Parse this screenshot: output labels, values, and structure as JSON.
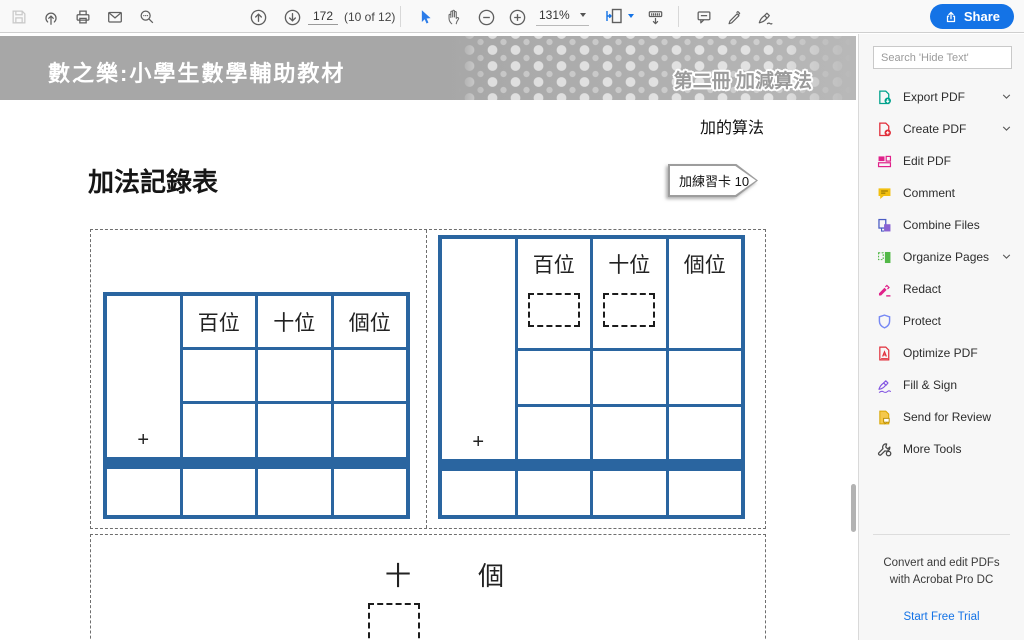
{
  "toolbar": {
    "page_input": "172",
    "page_count_label": "(10 of 12)",
    "zoom_level": "131%",
    "share_label": "Share"
  },
  "banner": {
    "title": "數之樂:小學生數學輔助教材",
    "volume_label": "第二冊 加減算法"
  },
  "document": {
    "section_label": "加的算法",
    "page_title": "加法記錄表",
    "practice_tag": "加練習卡 10",
    "tables": {
      "column_headers": [
        "百位",
        "十位",
        "個位"
      ],
      "plus_sign": "+"
    },
    "bottom_section": {
      "tens_label": "十",
      "ones_label": "個"
    }
  },
  "sidebar": {
    "search_placeholder": "Search 'Hide Text'",
    "items": [
      {
        "label": "Export PDF",
        "icon": "export-pdf-icon",
        "expandable": true
      },
      {
        "label": "Create PDF",
        "icon": "create-pdf-icon",
        "expandable": true
      },
      {
        "label": "Edit PDF",
        "icon": "edit-pdf-icon",
        "expandable": false
      },
      {
        "label": "Comment",
        "icon": "comment-icon",
        "expandable": false
      },
      {
        "label": "Combine Files",
        "icon": "combine-files-icon",
        "expandable": false
      },
      {
        "label": "Organize Pages",
        "icon": "organize-pages-icon",
        "expandable": true
      },
      {
        "label": "Redact",
        "icon": "redact-icon",
        "expandable": false
      },
      {
        "label": "Protect",
        "icon": "protect-icon",
        "expandable": false
      },
      {
        "label": "Optimize PDF",
        "icon": "optimize-pdf-icon",
        "expandable": false
      },
      {
        "label": "Fill & Sign",
        "icon": "fill-sign-icon",
        "expandable": false
      },
      {
        "label": "Send for Review",
        "icon": "send-review-icon",
        "expandable": false
      },
      {
        "label": "More Tools",
        "icon": "more-tools-icon",
        "expandable": false
      }
    ],
    "promo_line1": "Convert and edit PDFs",
    "promo_line2": "with Acrobat Pro DC",
    "trial_link": "Start Free Trial"
  },
  "colors": {
    "accent_blue": "#1473e6",
    "table_blue": "#2a65a0",
    "banner_grey": "#a9a9a9"
  }
}
